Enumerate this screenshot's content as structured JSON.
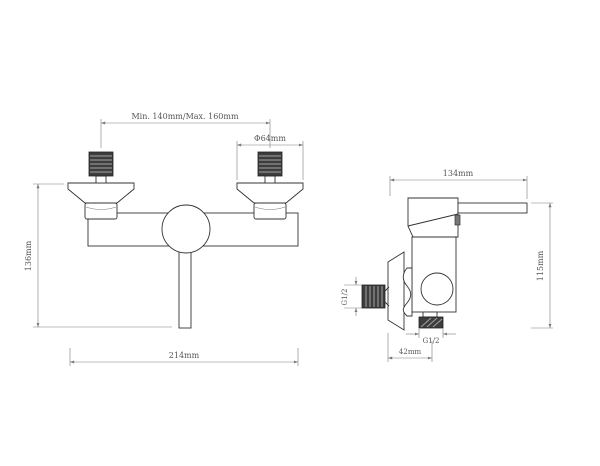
{
  "drawing": {
    "type": "technical-drawing",
    "subject": "wall-mounted shower mixer faucet, two orthographic views",
    "front_view": {
      "mounting_centers": "Min. 140mm/Max. 160mm",
      "escutcheon_diameter": "Φ64mm",
      "overall_height": "136mm",
      "overall_width": "214mm"
    },
    "side_view": {
      "overall_depth": "134mm",
      "overall_height": "115mm",
      "inlet_thread": "G1/2",
      "outlet_thread": "G1/2",
      "wall_to_outlet": "42mm"
    },
    "colors": {
      "background": "#ffffff",
      "outline": "#333333",
      "dimension_line": "#7a7a7a",
      "dimension_text": "#555555",
      "thread_fill": "#3d3d3d"
    }
  }
}
